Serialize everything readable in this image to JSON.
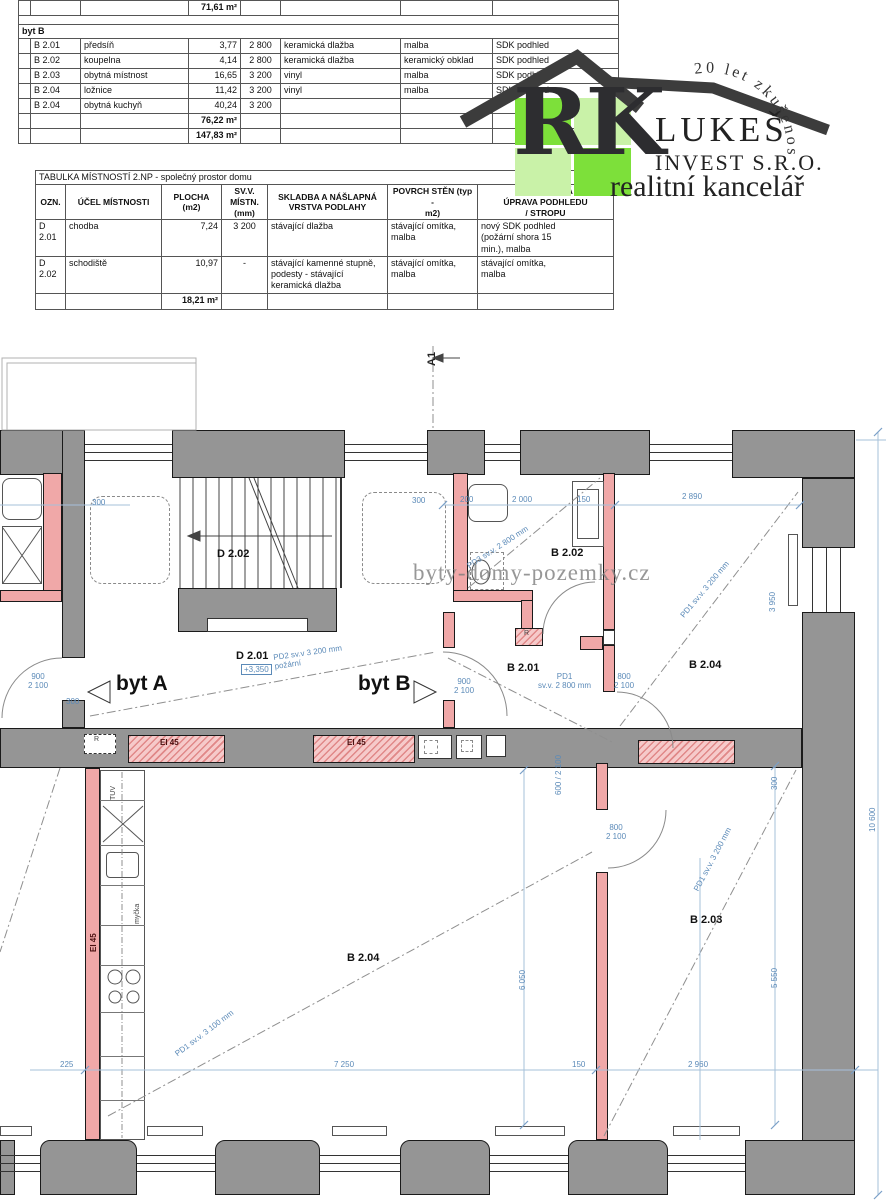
{
  "tables": {
    "t1": {
      "rows": [
        {
          "c": [
            "",
            "",
            "",
            "71,61 m²",
            "",
            "",
            "",
            ""
          ],
          "sum": true
        },
        {
          "spacer": true
        },
        {
          "section": "byt B"
        },
        {
          "c": [
            "",
            "B 2.01",
            "předsíň",
            "3,77",
            "2 800",
            "keramická dlažba",
            "malba",
            "SDK podhled"
          ]
        },
        {
          "c": [
            "",
            "B 2.02",
            "koupelna",
            "4,14",
            "2 800",
            "keramická dlažba",
            "keramický obklad",
            "SDK podhled"
          ]
        },
        {
          "c": [
            "",
            "B 2.03",
            "obytná místnost",
            "16,65",
            "3 200",
            "vinyl",
            "malba",
            "SDK podhled"
          ]
        },
        {
          "c": [
            "",
            "B 2.04",
            "ložnice",
            "11,42",
            "3 200",
            "vinyl",
            "malba",
            "SDK podhled"
          ]
        },
        {
          "c": [
            "",
            "B 2.04",
            "obytná kuchyň",
            "40,24",
            "3 200",
            "",
            "",
            ""
          ]
        },
        {
          "c": [
            "",
            "",
            "",
            "76,22 m²",
            "",
            "",
            "",
            ""
          ],
          "sum": true
        },
        {
          "c": [
            "",
            "",
            "",
            "147,83 m²",
            "",
            "",
            "",
            ""
          ],
          "sum": true
        }
      ]
    },
    "t2": {
      "title": "TABULKA MÍSTNOSTÍ 2.NP - společný prostor domu",
      "headers": [
        "OZN.",
        "ÚČEL MÍSTNOSTI",
        "PLOCHA\n(m2)",
        "SV.V.\nMÍSTN.\n(mm)",
        "SKLADBA A NÁŠLAPNÁ\nVRSTVA PODLAHY",
        "POVRCH STĚN (typ -\nm2)",
        "POVRCHOVÁ\nÚPRAVA PODHLEDU\n/ STROPU"
      ],
      "rows": [
        {
          "c": [
            "D 2.01",
            "chodba",
            "7,24",
            "3 200",
            "stávající dlažba",
            "stávající omítka,\nmalba",
            "nový SDK podhled\n(požární shora 15\nmin.), malba"
          ]
        },
        {
          "c": [
            "D 2.02",
            "schodiště",
            "10,97",
            "-",
            "stávající kamenné stupně,\npodesty - stávající\nkeramická dlažba",
            "stávající omítka,\nmalba",
            "stávající omítka,\nmalba"
          ]
        },
        {
          "c": [
            "",
            "",
            "18,21 m²",
            "",
            "",
            "",
            ""
          ],
          "sum": true
        }
      ]
    }
  },
  "logo": {
    "rk": "RK",
    "line1": "LUKEŠ",
    "line2": "INVEST S.R.O.",
    "line3": "realitní kancelář",
    "arc_text": "20 let zkušeností",
    "green_bright": "#7de03a",
    "green_pale": "#c9f2a8",
    "roof_color": "#3c3c3c"
  },
  "watermark": "byty-domy-pozemky.cz",
  "plan": {
    "labels": [
      {
        "t": "D 2.02",
        "x": 217,
        "y": 548,
        "c": "room"
      },
      {
        "t": "B 2.02",
        "x": 551,
        "y": 547,
        "c": "room"
      },
      {
        "t": "B 2.01",
        "x": 507,
        "y": 662,
        "c": "room"
      },
      {
        "t": "B 2.04",
        "x": 689,
        "y": 659,
        "c": "room"
      },
      {
        "t": "D 2.01",
        "x": 236,
        "y": 650,
        "c": "room"
      },
      {
        "t": "B 2.04",
        "x": 347,
        "y": 952,
        "c": "room"
      },
      {
        "t": "B 2.03",
        "x": 690,
        "y": 914,
        "c": "room"
      },
      {
        "t": "byt A",
        "x": 116,
        "y": 672,
        "c": "apt"
      },
      {
        "t": "byt B",
        "x": 358,
        "y": 672,
        "c": "apt"
      },
      {
        "t": "300",
        "x": 92,
        "y": 498,
        "c": "dim"
      },
      {
        "t": "300",
        "x": 66,
        "y": 697,
        "c": "dim"
      },
      {
        "t": "300",
        "x": 412,
        "y": 496,
        "c": "dim"
      },
      {
        "t": "200",
        "x": 460,
        "y": 495,
        "c": "dim"
      },
      {
        "t": "2 000",
        "x": 512,
        "y": 495,
        "c": "dim"
      },
      {
        "t": "150",
        "x": 577,
        "y": 495,
        "c": "dim"
      },
      {
        "t": "2 890",
        "x": 682,
        "y": 492,
        "c": "dim"
      },
      {
        "t": "225",
        "x": 60,
        "y": 1060,
        "c": "dim"
      },
      {
        "t": "7 250",
        "x": 334,
        "y": 1060,
        "c": "dim"
      },
      {
        "t": "150",
        "x": 572,
        "y": 1060,
        "c": "dim"
      },
      {
        "t": "2 960",
        "x": 688,
        "y": 1060,
        "c": "dim"
      },
      {
        "t": "900\n2 100",
        "x": 28,
        "y": 672,
        "c": "dim2"
      },
      {
        "t": "900\n2 100",
        "x": 454,
        "y": 677,
        "c": "dim2"
      },
      {
        "t": "800\n2 100",
        "x": 614,
        "y": 672,
        "c": "dim2"
      },
      {
        "t": "800\n2 100",
        "x": 606,
        "y": 823,
        "c": "dim2"
      },
      {
        "t": "PD1\nsv.v. 2 800 mm",
        "x": 538,
        "y": 672,
        "c": "dim2"
      },
      {
        "t": "3 950",
        "x": 768,
        "y": 612,
        "c": "dimv"
      },
      {
        "t": "300",
        "x": 770,
        "y": 790,
        "c": "dimv"
      },
      {
        "t": "5 550",
        "x": 770,
        "y": 988,
        "c": "dimv"
      },
      {
        "t": "10 600",
        "x": 868,
        "y": 832,
        "c": "dimv"
      },
      {
        "t": "6 050",
        "x": 518,
        "y": 990,
        "c": "dimv"
      },
      {
        "t": "600 / 2 100",
        "x": 554,
        "y": 795,
        "c": "dimv"
      },
      {
        "t": "PD3 sv.v. 2 800 mm",
        "x": 468,
        "y": 562,
        "c": "diag",
        "a": -33
      },
      {
        "t": "PD1 sv.v. 3 200 mm",
        "x": 682,
        "y": 612,
        "c": "diag",
        "a": -50
      },
      {
        "t": "PD1 sv.v. 3 100 mm",
        "x": 176,
        "y": 1050,
        "c": "diag",
        "a": -37
      },
      {
        "t": "PD1 sv.v. 3 200 mm",
        "x": 696,
        "y": 886,
        "c": "diag",
        "a": -62
      },
      {
        "t": "PD2 sv.v 3 200 mm\npožární",
        "x": 274,
        "y": 653,
        "c": "diag2",
        "a": -8
      },
      {
        "t": "+3,350",
        "x": 241,
        "y": 664,
        "c": "elev"
      },
      {
        "t": "EI 45",
        "x": 160,
        "y": 738,
        "c": "ei"
      },
      {
        "t": "EI 45",
        "x": 347,
        "y": 738,
        "c": "ei"
      },
      {
        "t": "EI 45",
        "x": 89,
        "y": 952,
        "c": "eiv"
      },
      {
        "t": "TUV",
        "x": 110,
        "y": 800,
        "c": "tinyv"
      },
      {
        "t": "myčka",
        "x": 134,
        "y": 924,
        "c": "tinyv"
      },
      {
        "t": "R",
        "x": 94,
        "y": 736,
        "c": "tiny"
      },
      {
        "t": "R",
        "x": 524,
        "y": 630,
        "c": "tiny"
      },
      {
        "t": "A1",
        "x": 426,
        "y": 366,
        "c": "a1"
      }
    ]
  }
}
